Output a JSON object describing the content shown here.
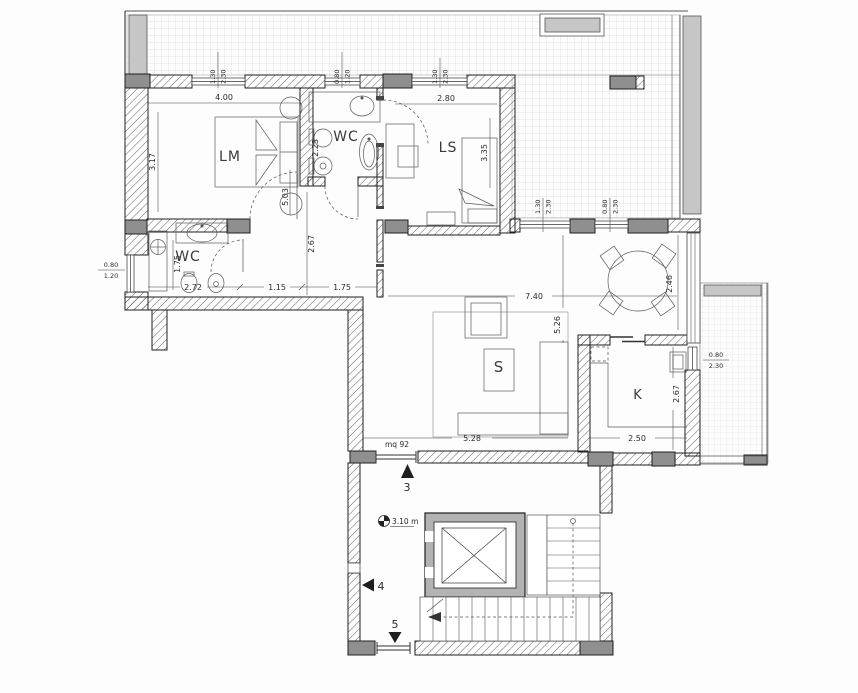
{
  "plan": {
    "rooms": {
      "lm": "LM",
      "wc1": "WC",
      "ls": "LS",
      "wc2": "WC",
      "living": "S",
      "kitchen": "K"
    },
    "dimensions": {
      "lm_width": "4.00",
      "lm_depth": "3.17",
      "lm_total": "5.03",
      "wc1_depth": "2.23",
      "ls_width": "2.80",
      "ls_depth": "3.35",
      "wc2_depth": "1.75",
      "wc2_width": "2.72",
      "hall_seg1": "1.15",
      "hall_seg2": "1.75",
      "hall_depth": "2.67",
      "living_width": "7.40",
      "dining_depth": "2.46",
      "living_depth": "5.26",
      "sofa_span": "5.28",
      "kitchen_width": "2.50",
      "kitchen_depth": "2.67"
    },
    "windows": {
      "lm_top": {
        "w": "1.30",
        "h": "2.30"
      },
      "wc1_top": {
        "w": "0.80",
        "h": "1.20"
      },
      "ls_top": {
        "w": "1.30",
        "h": "2.30"
      },
      "terrace_a": {
        "w": "1.30",
        "h": "2.30"
      },
      "terrace_b": {
        "w": "0.80",
        "h": "2.30"
      },
      "wc2_left": {
        "w": "0.80",
        "h": "1.20"
      },
      "kitchen_right": {
        "w": "0.80",
        "h": "2.30"
      }
    },
    "annotations": {
      "area": "mq 92",
      "level": "3.10 m",
      "stair_num_up": "3",
      "stair_num_mid": "4",
      "stair_num_down": "5"
    },
    "colors": {
      "wall_line": "#1f1f1f",
      "pier_fill": "#8f8f8f",
      "planter_fill": "#c6c6c6",
      "tile_line": "#c8c8c8",
      "furniture_line": "#5a5a5a"
    }
  }
}
